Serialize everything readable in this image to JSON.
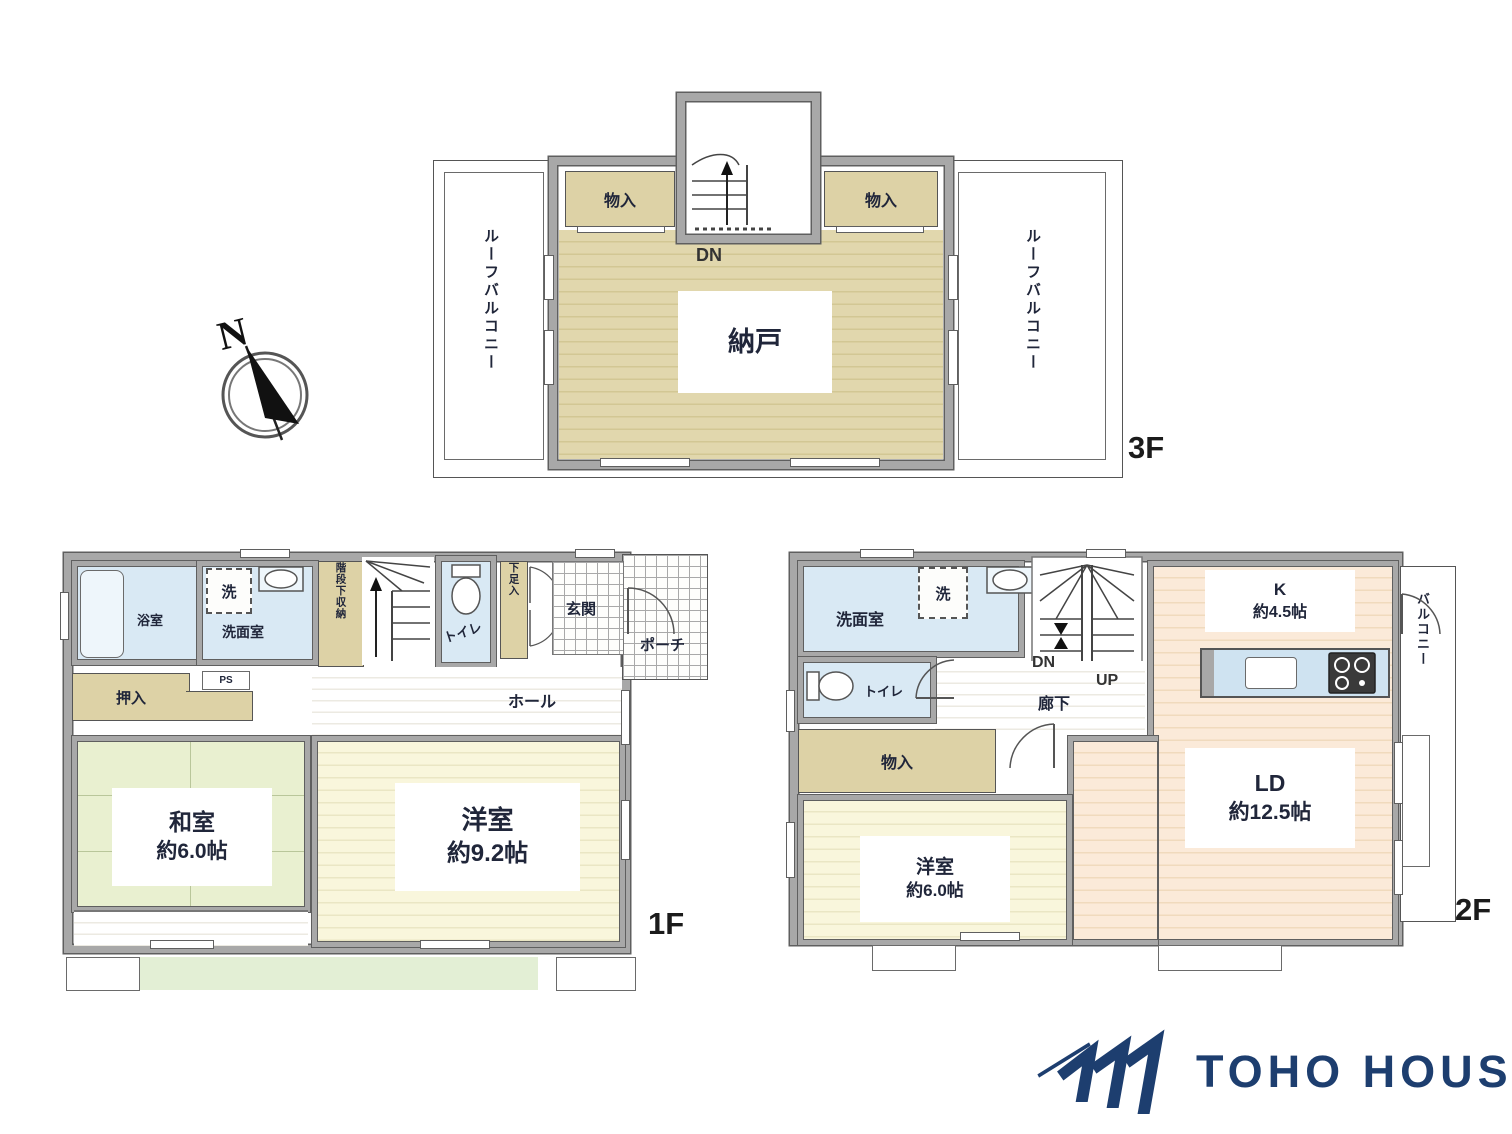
{
  "compass": {
    "north": "N"
  },
  "f3": {
    "floor_label": "3F",
    "storage_room": "納戸",
    "closet_left": "物入",
    "closet_right": "物入",
    "roof_balcony_left": "ルーフバルコニー",
    "roof_balcony_right": "ルーフバルコニー",
    "stairs_down": "DN"
  },
  "f1": {
    "floor_label": "1F",
    "bathroom": "浴室",
    "washroom": "洗面室",
    "washer": "洗",
    "under_stair_storage": "階段下収納",
    "stairs_up": "UP",
    "toilet": "トイレ",
    "shoe_cabinet": "下足入",
    "entrance": "玄関",
    "porch": "ポーチ",
    "closet": "押入",
    "pipe_space": "PS",
    "hall": "ホール",
    "japanese_room": "和室",
    "japanese_room_size": "約6.0帖",
    "western_room": "洋室",
    "western_room_size": "約9.2帖"
  },
  "f2": {
    "floor_label": "2F",
    "washroom": "洗面室",
    "washer": "洗",
    "toilet": "トイレ",
    "closet": "物入",
    "stairs_down": "DN",
    "stairs_up": "UP",
    "corridor": "廊下",
    "kitchen": "K",
    "kitchen_size": "約4.5帖",
    "living_dining": "LD",
    "living_dining_size": "約12.5帖",
    "western_room": "洋室",
    "western_room_size": "約6.0帖",
    "balcony": "バルコニー"
  },
  "logo": {
    "brand": "TOHO HOUSE"
  },
  "colors": {
    "brand_navy": "#1d3e6f",
    "wall_gray": "#a8a8a8",
    "tan_floor": "#e0d6ae",
    "blue_room": "#d9e9f4",
    "tatami_green": "#e9f0d0",
    "cream_floor": "#f8f5da",
    "peach_floor": "#faeada",
    "garden_green": "#e3efd5"
  }
}
